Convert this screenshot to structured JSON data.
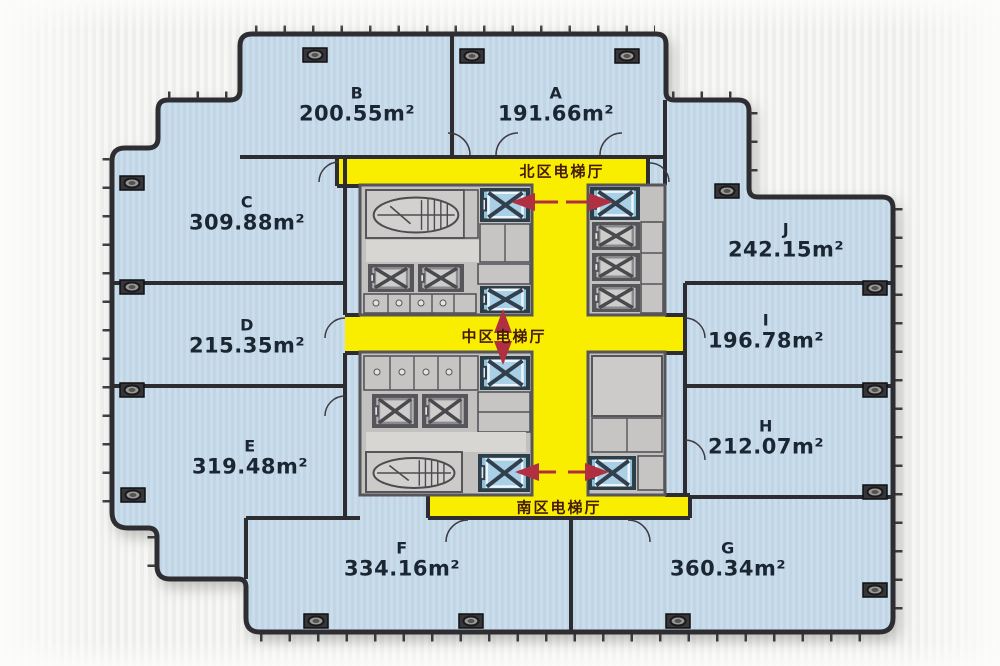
{
  "page": {
    "type": "office-floor-plan"
  },
  "units": [
    {
      "id": "B",
      "area": "200.55m²"
    },
    {
      "id": "A",
      "area": "191.66m²"
    },
    {
      "id": "C",
      "area": "309.88m²"
    },
    {
      "id": "D",
      "area": "215.35m²"
    },
    {
      "id": "E",
      "area": "319.48m²"
    },
    {
      "id": "F",
      "area": "334.16m²"
    },
    {
      "id": "G",
      "area": "360.34m²"
    },
    {
      "id": "H",
      "area": "212.07m²"
    },
    {
      "id": "I",
      "area": "196.78m²"
    },
    {
      "id": "J",
      "area": "242.15m²"
    }
  ],
  "corridors": {
    "north": "北区电梯厅",
    "central": "中区电梯厅",
    "south": "南区电梯厅"
  },
  "colors": {
    "room_fill": "#c9dcea",
    "corridor_yellow": "#f9ee00",
    "wall": "#2d2d31",
    "core_gray": "#c3c1bf",
    "elevator_blue": "#8fc2dc",
    "arrow_red": "#b03042",
    "unit_label": "#1b2633",
    "corridor_label": "#431a0a"
  }
}
